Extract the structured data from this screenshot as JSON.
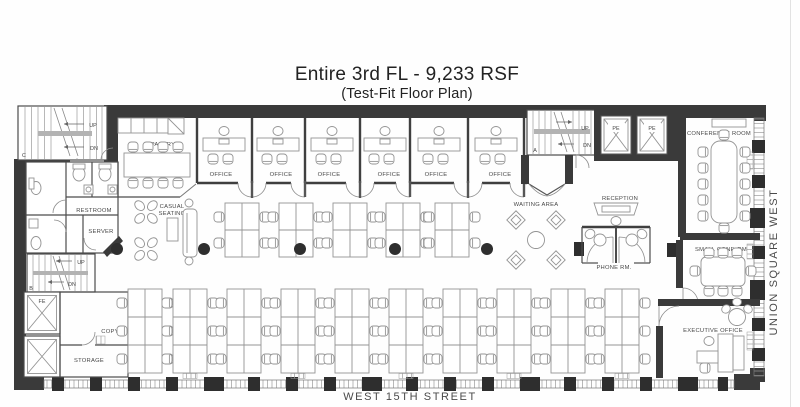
{
  "title": {
    "line1": "Entire 3rd FL - 9,233 RSF",
    "line2": "(Test-Fit Floor Plan)"
  },
  "streets": {
    "south": "WEST 15TH STREET",
    "east": "UNION SQUARE WEST"
  },
  "labels": {
    "pantry": "PANTRY",
    "office": "OFFICE",
    "restroom": "RESTROOM",
    "server": "SERVER",
    "casual_line1": "CASUAL",
    "casual_line2": "SEATING",
    "copy": "COPY",
    "storage": "STORAGE",
    "waiting_area": "WAITING AREA",
    "reception": "RECEPTION",
    "phone_rm": "PHONE RM.",
    "conference_room": "CONFERENCE ROOM",
    "small_conf_rm": "SMALL CONF. RM",
    "executive_office": "EXECUTIVE OFFICE",
    "fe": "FE",
    "pe": "PE",
    "up": "UP",
    "dn": "DN",
    "stair_a": "A",
    "stair_b": "B",
    "stair_c": "C"
  }
}
